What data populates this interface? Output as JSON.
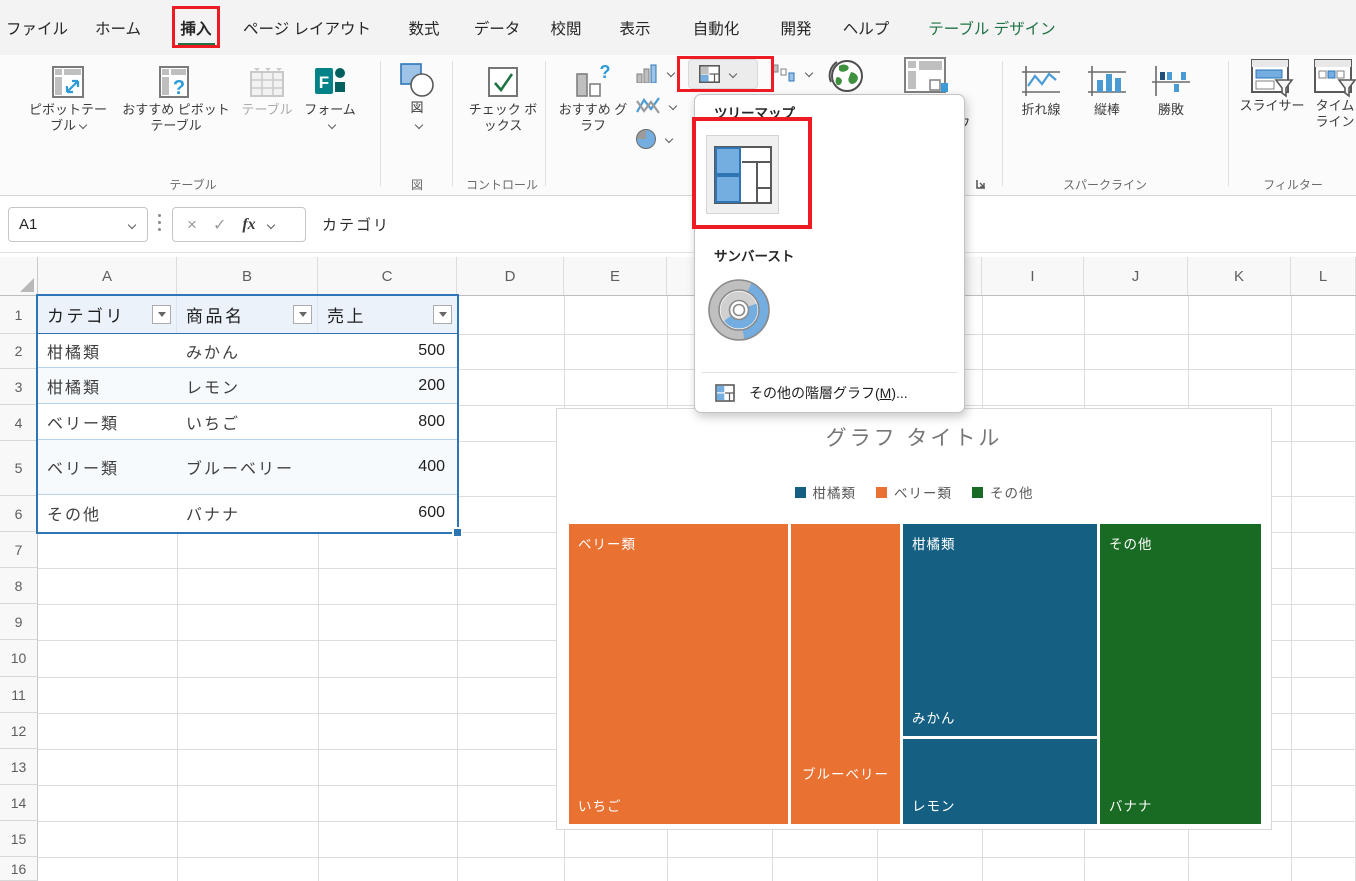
{
  "menu": {
    "tabs": [
      "ファイル",
      "ホーム",
      "挿入",
      "ページ レイアウト",
      "数式",
      "データ",
      "校閲",
      "表示",
      "自動化",
      "開発",
      "ヘルプ",
      "テーブル デザイン"
    ],
    "active_tab": "挿入",
    "contextual_tab": "テーブル デザイン"
  },
  "ribbon": {
    "pivot_table": "ピボットテーブル",
    "recommended_pivot": "おすすめ ピボットテーブル",
    "table_button": "テーブル",
    "forms": "フォーム",
    "group_table": "テーブル",
    "illustrations": "図",
    "group_illustrations": "図",
    "checkbox": "チェック ボックス",
    "group_controls": "コントロール",
    "recommended_chart": "おすすめ グラフ",
    "pivot_chart": "ピボットグラフ",
    "spark_line": "折れ線",
    "spark_column": "縦棒",
    "spark_winloss": "勝敗",
    "group_sparklines": "スパークライン",
    "slicer": "スライサー",
    "timeline": "タイムライン",
    "group_filters": "フィルター"
  },
  "chart_menu": {
    "treemap_header": "ツリーマップ",
    "sunburst_header": "サンバースト",
    "more_item_pre": "その他の階層グラフ(",
    "more_item_key": "M",
    "more_item_post": ")..."
  },
  "formula_bar": {
    "name_box": "A1",
    "formula": "カテゴリ"
  },
  "grid": {
    "columns": [
      "A",
      "B",
      "C",
      "D",
      "E",
      "F",
      "G",
      "H",
      "I",
      "J",
      "K",
      "L"
    ],
    "rows": [
      "1",
      "2",
      "3",
      "4",
      "5",
      "6",
      "7",
      "8",
      "9",
      "10",
      "11",
      "12",
      "13",
      "14",
      "15",
      "16"
    ]
  },
  "sheet_table": {
    "headers": [
      "カテゴリ",
      "商品名",
      "売上"
    ],
    "rows": [
      [
        "柑橘類",
        "みかん",
        "500"
      ],
      [
        "柑橘類",
        "レモン",
        "200"
      ],
      [
        "ベリー類",
        "いちご",
        "800"
      ],
      [
        "ベリー類",
        "ブルーベリー",
        "400"
      ],
      [
        "その他",
        "バナナ",
        "600"
      ]
    ]
  },
  "chart_data": {
    "type": "treemap",
    "title": "グラフ タイトル",
    "legend": [
      "柑橘類",
      "ベリー類",
      "その他"
    ],
    "legend_colors": [
      "#156082",
      "#E97132",
      "#196B24"
    ],
    "legend_position": "top",
    "series": [
      {
        "category": "ベリー類",
        "color": "#E97132",
        "items": [
          {
            "name": "いちご",
            "value": 800
          },
          {
            "name": "ブルーベリー",
            "value": 400
          }
        ]
      },
      {
        "category": "柑橘類",
        "color": "#156082",
        "items": [
          {
            "name": "みかん",
            "value": 500
          },
          {
            "name": "レモン",
            "value": 200
          }
        ]
      },
      {
        "category": "その他",
        "color": "#196B24",
        "items": [
          {
            "name": "バナナ",
            "value": 600
          }
        ]
      }
    ],
    "total": 2500
  },
  "colors": {
    "annotation_red": "#ED1C24",
    "excel_green": "#217346",
    "accent_blue": "#156082",
    "accent_orange": "#E97132",
    "accent_green": "#196B24",
    "table_border_blue": "#2E75B6"
  }
}
